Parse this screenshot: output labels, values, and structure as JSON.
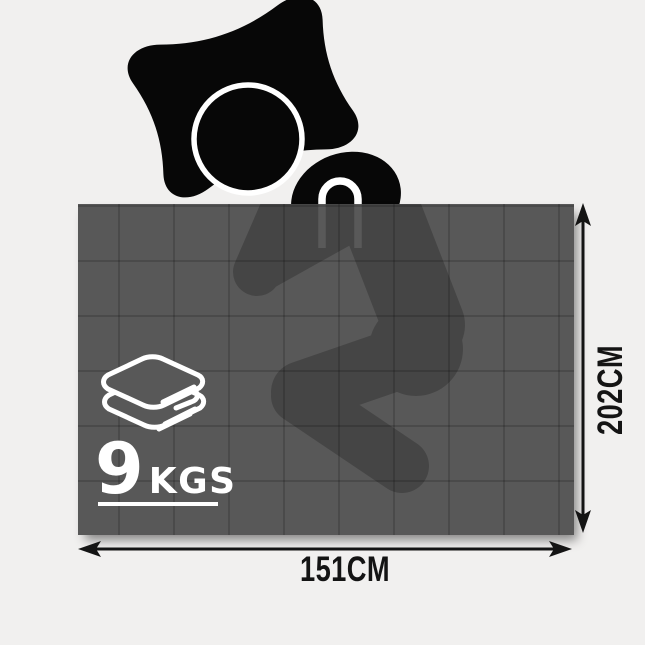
{
  "figure": {
    "weight_number": "9",
    "weight_unit": "KGS",
    "width_label": "151CM",
    "height_label": "202CM"
  },
  "icons": {
    "sleeping_person": "black silhouette of person sleeping on side under blanket",
    "pillow": "pillow-icon",
    "head": "head-icon",
    "hand": "hand-near-face-icon",
    "folded_blankets": "folded-blankets-stack-icon",
    "width_arrow": "horizontal-double-arrow-icon",
    "height_arrow": "vertical-double-arrow-icon"
  },
  "colors": {
    "background": "#f1f0ef",
    "silhouette_black": "#070707",
    "blanket_overlay": "rgba(75,75,75,0.92)",
    "blanket_gray": "#585858",
    "grid_line": "rgba(0,0,0,0.16)",
    "white": "#ffffff",
    "dimension_ink": "#141414"
  }
}
